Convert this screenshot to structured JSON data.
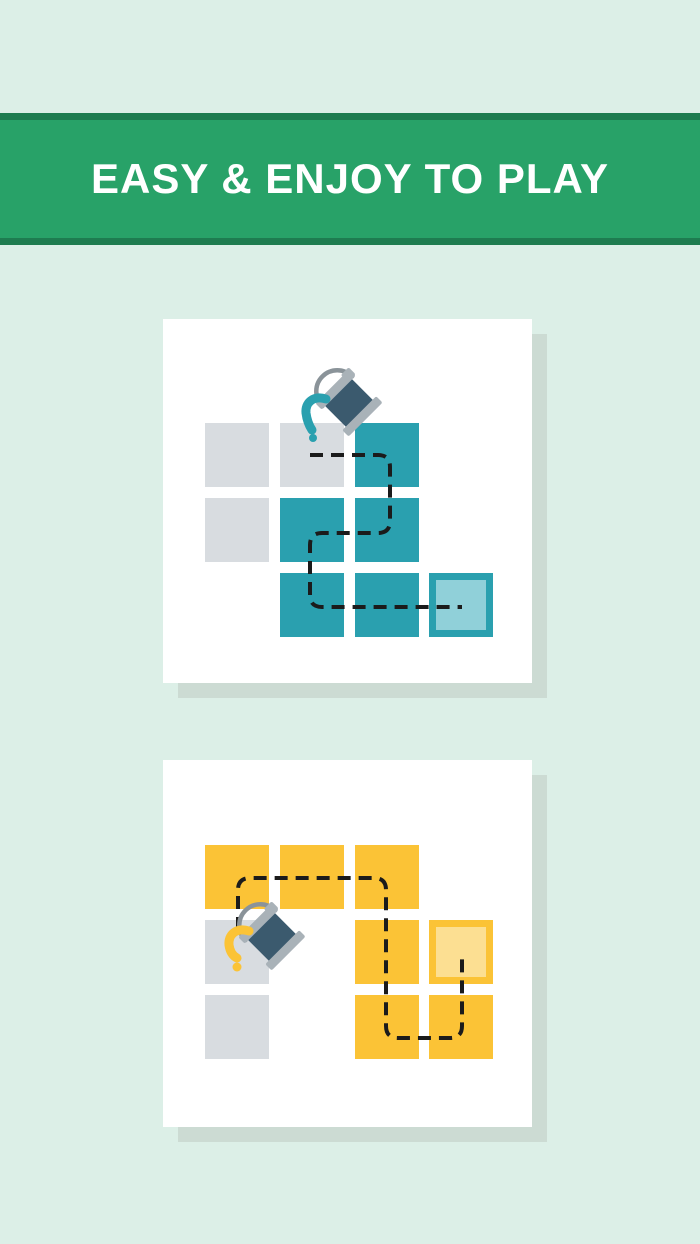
{
  "banner": {
    "title": "EASY & ENJOY TO PLAY"
  },
  "colors": {
    "bg": "#DCEFE7",
    "banner-green": "#28A268",
    "banner-dark": "#1E7C50",
    "shadow": "#CCDBD3",
    "gray-cell": "#D8DCE0",
    "teal": "#2AA0AF",
    "teal-light": "#90D0D9",
    "yellow": "#FBC336",
    "yellow-light": "#FCDF92",
    "bucket-dark": "#3B5A6E",
    "bucket-rim": "#A9B2B8",
    "handle-gray": "#8A9399",
    "dash": "#1B1B1B"
  },
  "cards": [
    {
      "name": "teal-puzzle-card",
      "icon": "paint-bucket-icon",
      "paint": "teal",
      "grid": {
        "cell": 64,
        "cols": [
          42,
          117,
          192,
          266
        ],
        "rows": [
          104,
          179,
          254
        ],
        "cells": [
          {
            "col": 0,
            "row": 0,
            "type": "gray"
          },
          {
            "col": 1,
            "row": 0,
            "type": "gray"
          },
          {
            "col": 2,
            "row": 0,
            "type": "teal"
          },
          {
            "col": 0,
            "row": 1,
            "type": "gray"
          },
          {
            "col": 1,
            "row": 1,
            "type": "teal"
          },
          {
            "col": 2,
            "row": 1,
            "type": "teal"
          },
          {
            "col": 1,
            "row": 2,
            "type": "teal"
          },
          {
            "col": 2,
            "row": 2,
            "type": "teal"
          },
          {
            "col": 3,
            "row": 2,
            "type": "target-teal"
          }
        ]
      },
      "path": "M 147,136 H 215 Q 227,136 227,148 V 202 Q 227,214 215,214 H 159 Q 147,214 147,226 V 276 Q 147,288 159,288 H 299",
      "bucket": {
        "transform": "translate(187,85) rotate(-45)",
        "paint_stream": "M 163,80 C 150,76 142,84 143,94 C 144,102 147,108 149,111",
        "drip": {
          "x": 150,
          "y": 119,
          "r": 4
        }
      }
    },
    {
      "name": "yellow-puzzle-card",
      "icon": "paint-bucket-icon",
      "paint": "yellow",
      "grid": {
        "cell": 64,
        "cols": [
          42,
          117,
          192,
          266
        ],
        "rows": [
          85,
          160,
          235
        ],
        "cells": [
          {
            "col": 0,
            "row": 0,
            "type": "yellow"
          },
          {
            "col": 1,
            "row": 0,
            "type": "yellow"
          },
          {
            "col": 2,
            "row": 0,
            "type": "yellow"
          },
          {
            "col": 0,
            "row": 1,
            "type": "gray"
          },
          {
            "col": 2,
            "row": 1,
            "type": "yellow"
          },
          {
            "col": 3,
            "row": 1,
            "type": "target-yellow"
          },
          {
            "col": 0,
            "row": 2,
            "type": "gray"
          },
          {
            "col": 2,
            "row": 2,
            "type": "yellow"
          },
          {
            "col": 3,
            "row": 2,
            "type": "yellow"
          }
        ]
      },
      "path": "M 75,170 V 130 Q 75,118 87,118 H 211 Q 223,118 223,130 V 266 Q 223,278 235,278 H 287 Q 299,278 299,266 V 192",
      "bucket": {
        "transform": "translate(110,178) rotate(-45)",
        "paint_stream": "M 86,171 C 73,167 65,175 66,185 C 67,192 70,196 74,198",
        "drip": {
          "x": 74,
          "y": 207,
          "r": 4.5
        }
      }
    }
  ]
}
